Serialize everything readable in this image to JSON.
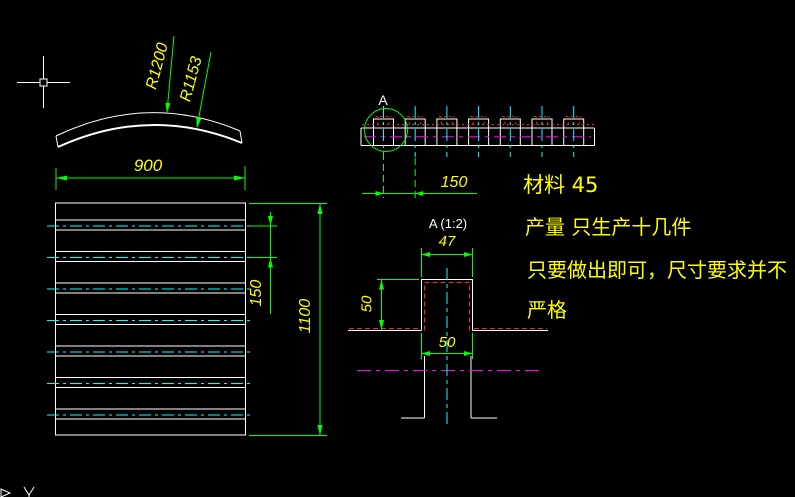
{
  "colors": {
    "background": "#000000",
    "geometry": "#ffffff",
    "dimension": "#00ff00",
    "dim_text": "#ffff00",
    "centerline": "#00ffff",
    "hidden": "#ff2222",
    "phantom": "#ff00ff"
  },
  "arc_view": {
    "radius_outer": "R1200",
    "radius_inner": "R1153",
    "chord": "900"
  },
  "plan_view": {
    "pitch": "150",
    "length": "1100"
  },
  "side_view": {
    "detail_mark": "A",
    "pitch": "150"
  },
  "detail_view": {
    "title": "A (1:2)",
    "top_width": "47",
    "height": "50",
    "bottom_width": "50"
  },
  "notes": {
    "material": "材料  45",
    "quantity": "产量  只生产十几件",
    "note_line1": "只要做出即可，尺寸要求并不",
    "note_line2": "严格"
  }
}
